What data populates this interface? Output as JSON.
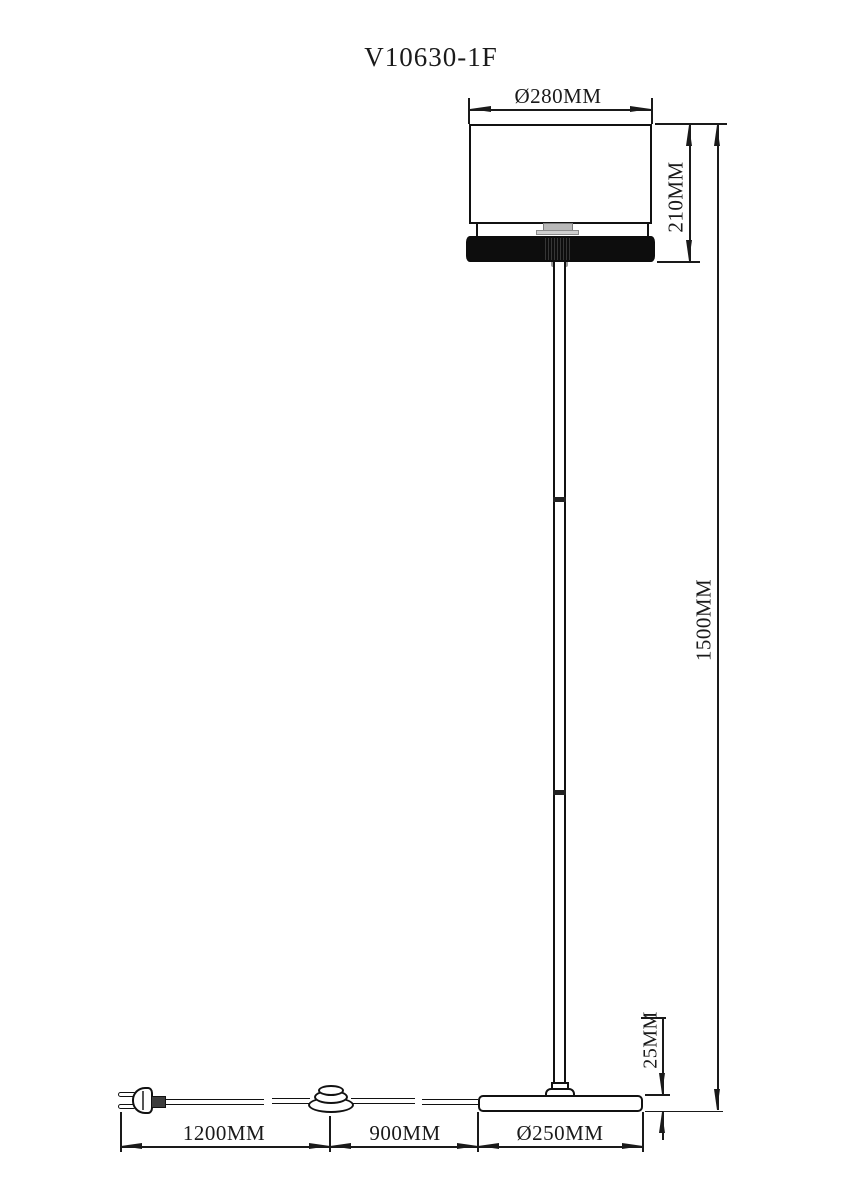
{
  "title": "V10630-1F",
  "dimensions": {
    "shade_diameter": "Ø280MM",
    "shade_height": "210MM",
    "total_height": "1500MM",
    "base_thickness": "25MM",
    "plug_to_switch": "1200MM",
    "switch_to_base": "900MM",
    "base_diameter": "Ø250MM"
  },
  "colors": {
    "line": "#1a1a1a",
    "shade_fill": "#ffffff",
    "band_fill": "#0d0d0d",
    "background": "#ffffff"
  }
}
